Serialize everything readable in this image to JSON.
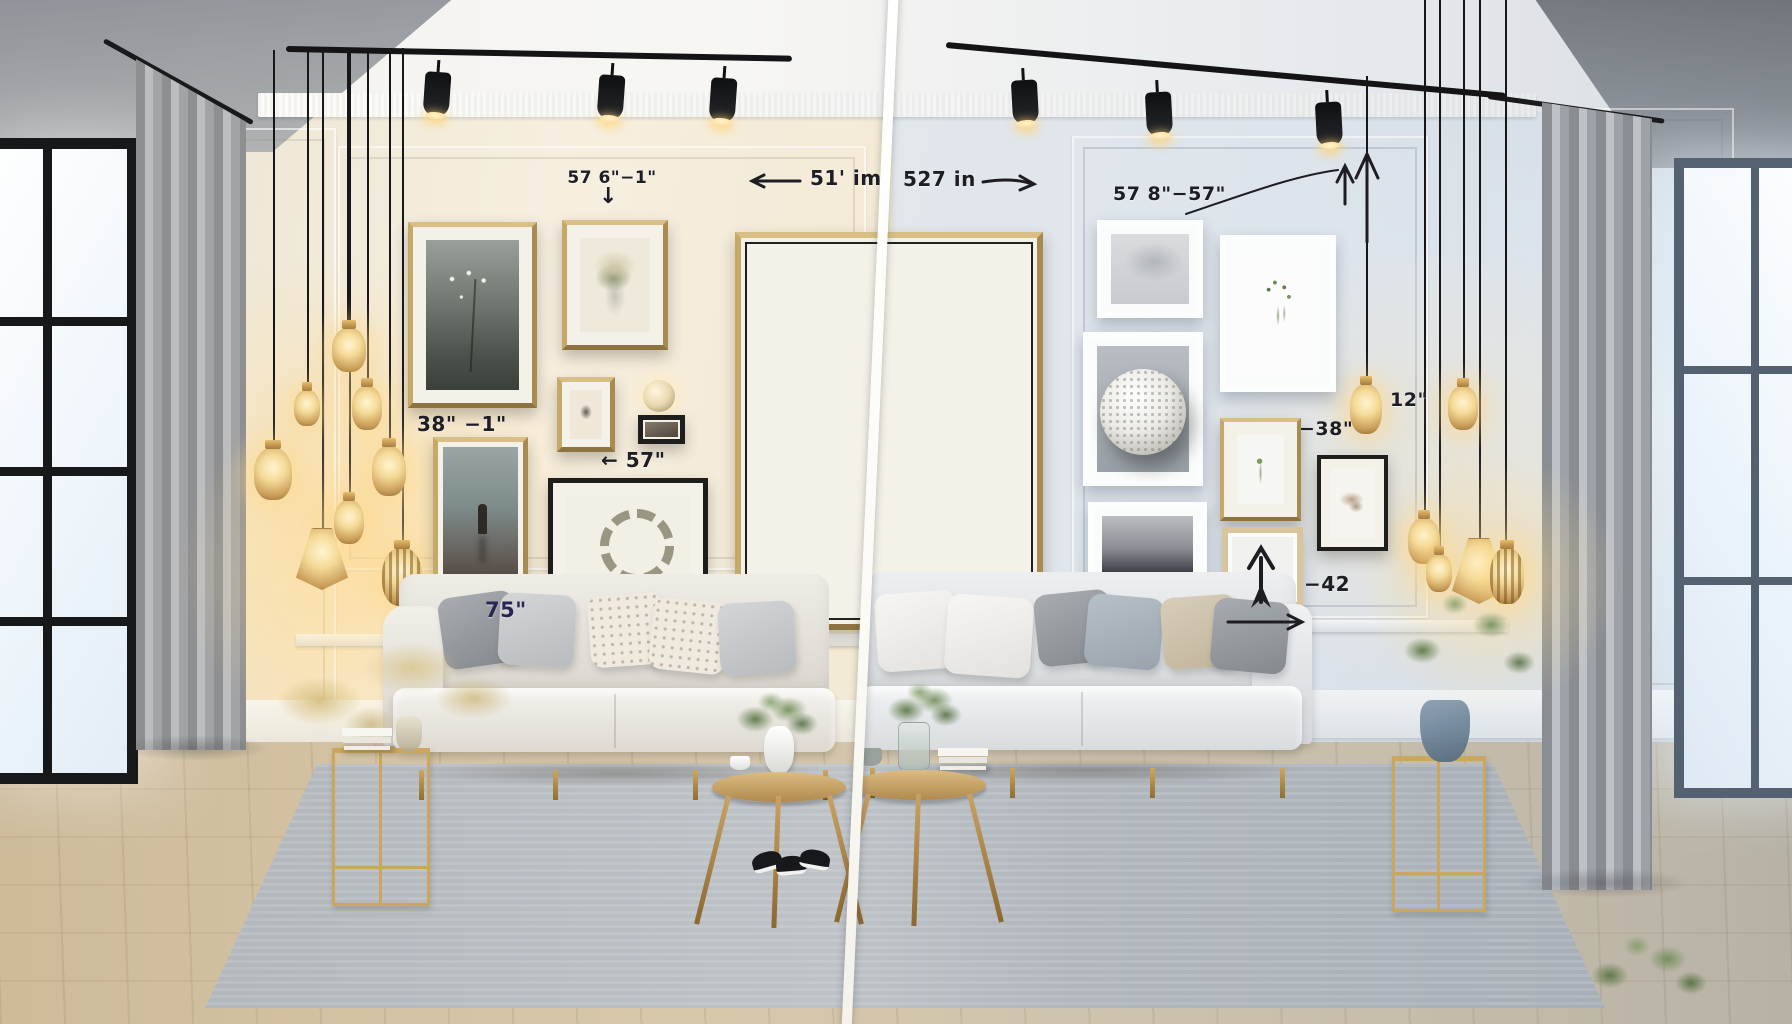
{
  "annotations": {
    "left_wall": {
      "top_frame": "57 6\"−1\"",
      "gap_38": "38\" −1\"",
      "width_57": "57\"",
      "height_75": "75\"",
      "span_51": "51' im"
    },
    "right_wall": {
      "span_527": "527 in",
      "range_57_8": "57 8\"−57\"",
      "drop_12": "12\"",
      "offset_38": "−38\"",
      "offset_42": "−42"
    }
  },
  "icons": {
    "down_arrow": "↓",
    "left_arrow": "←"
  },
  "palette": {
    "frame_gold": "#b9995f",
    "annotation_ink": "#1d1d24",
    "annotation_navy": "#2a2654",
    "wall_warm": "#f2ebdd",
    "wall_cool": "#dde4eb",
    "track_black": "#141417",
    "rug_gray": "#b6bcc1",
    "lamp_glow": "#ffd998",
    "divider_white": "#ffffff"
  }
}
